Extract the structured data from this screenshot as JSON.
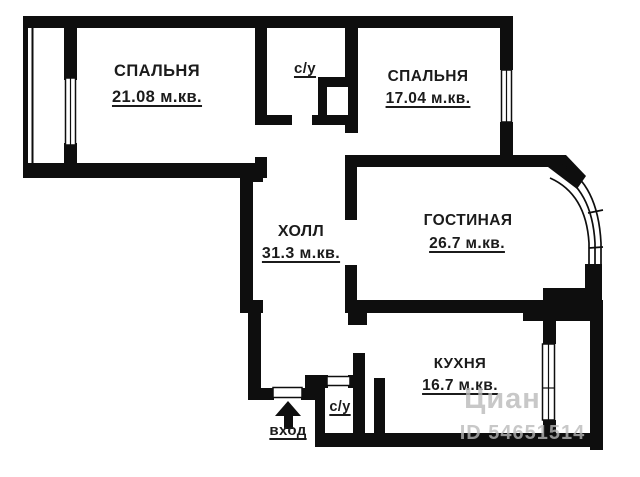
{
  "rooms": [
    {
      "name": "СПАЛЬНЯ",
      "area": "21.08 м.кв."
    },
    {
      "name": "с/у"
    },
    {
      "name": "СПАЛЬНЯ",
      "area": "17.04 м.кв."
    },
    {
      "name": "ХОЛЛ",
      "area": "31.3 м.кв."
    },
    {
      "name": "ГОСТИНАЯ",
      "area": "26.7 м.кв."
    },
    {
      "name": "КУХНЯ",
      "area": "16.7 м.кв."
    },
    {
      "name": "с/у"
    }
  ],
  "entrance": {
    "label": "вход"
  },
  "watermark": {
    "brand": "Циан",
    "listing_id": "ID 54651514"
  },
  "colors": {
    "wall": "#0e0e0e",
    "background": "#ffffff",
    "text": "#1b1b1b",
    "watermark": "#b9b9b9"
  }
}
